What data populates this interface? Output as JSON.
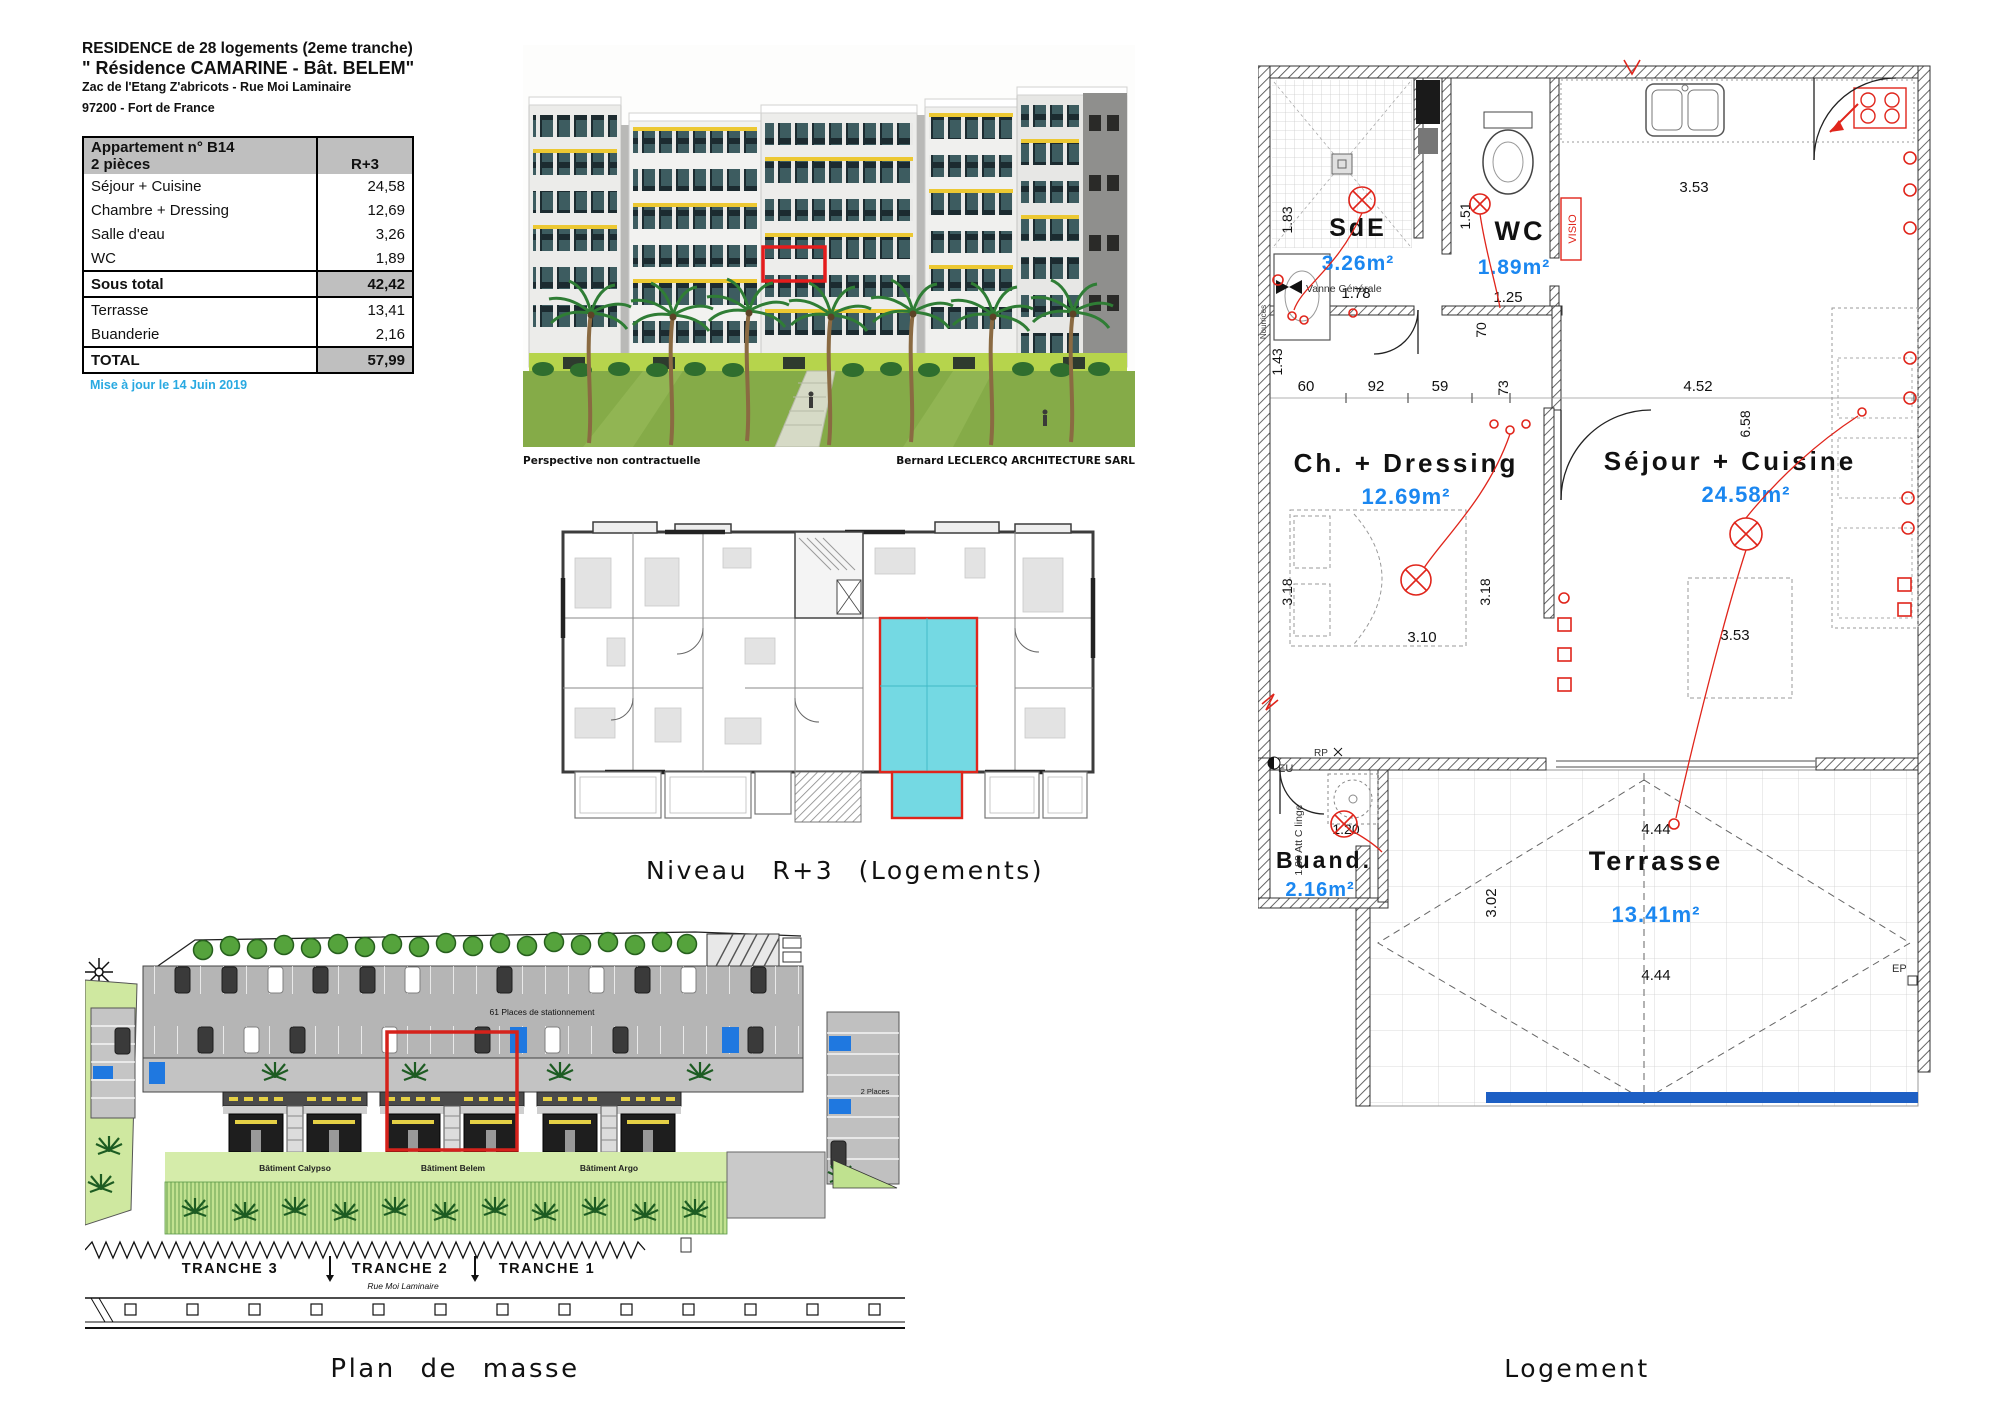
{
  "doc": {
    "title_line1": "RESIDENCE de 28 logements (2eme tranche)",
    "title_line2": "\" Résidence CAMARINE - Bât. BELEM\"",
    "title_line3": "Zac de l'Etang Z'abricots - Rue Moi Laminaire",
    "title_line4": "97200  - Fort de France",
    "update_note": "Mise à jour le 14 Juin 2019"
  },
  "area_table": {
    "header_title": "Appartement n° B14",
    "header_sub": "2 pièces",
    "header_col": "R+3",
    "rows": [
      {
        "label": "Séjour + Cuisine",
        "value": "24,58"
      },
      {
        "label": "Chambre + Dressing",
        "value": "12,69"
      },
      {
        "label": "Salle d'eau",
        "value": "3,26"
      },
      {
        "label": "WC",
        "value": "1,89"
      },
      {
        "label": "Sous total",
        "value": "42,42"
      },
      {
        "label": "Terrasse",
        "value": "13,41"
      },
      {
        "label": "Buanderie",
        "value": "2,16"
      },
      {
        "label": "TOTAL",
        "value": "57,99"
      }
    ]
  },
  "perspective": {
    "caption_left": "Perspective non contractuelle",
    "caption_right": "Bernard LECLERCQ ARCHITECTURE SARL"
  },
  "floor_plan": {
    "caption": "Niveau R+3 (Logements)"
  },
  "site_plan": {
    "caption": "Plan de masse",
    "parking_label": "61 Places de stationnement",
    "places_right_label": "2 Places",
    "building_left": "Bâtiment Calypso",
    "building_middle": "Bâtiment Belem",
    "building_right": "Bâtiment Argo",
    "tranche_3": "TRANCHE 3",
    "tranche_2": "TRANCHE 2",
    "tranche_1": "TRANCHE 1",
    "street": "Rue Moi Laminaire"
  },
  "apartment": {
    "caption": "Logement",
    "rooms": {
      "sde": {
        "name": "SdE",
        "area": "3.26m²"
      },
      "wc": {
        "name": "WC",
        "area": "1.89m²"
      },
      "ch": {
        "name": "Ch. + Dressing",
        "area": "12.69m²"
      },
      "sejour": {
        "name": "Séjour + Cuisine",
        "area": "24.58m²"
      },
      "buand": {
        "name": "Buand.",
        "area": "2.16m²"
      },
      "terrasse": {
        "name": "Terrasse",
        "area": "13.41m²"
      }
    },
    "dims": {
      "sde_width": "1.78",
      "sde_height": "1.83",
      "left_wall": "1.43",
      "wc_height": "1.51",
      "wc_width": "1.25",
      "kitchen_width": "3.53",
      "hall_a": "60",
      "hall_b": "92",
      "hall_c": "59",
      "hall_d": "73",
      "hall_e": "70",
      "sejour_top": "4.52",
      "sejour_right": "6.58",
      "ch_left": "3.18",
      "ch_right": "3.18",
      "ch_bottom": "3.10",
      "sejour_bottom": "3.53",
      "buand_width": "1.20",
      "buand_left": "1.80 Att C linge",
      "terrasse_height": "3.02",
      "terrasse_top": "4.44",
      "terrasse_bottom": "4.44"
    },
    "annotations": {
      "vanne": "Vanne Générale",
      "visio": "VISIO",
      "eu": "EU",
      "rp": "RP",
      "ep": "EP",
      "nourrices": "Nourrices"
    }
  },
  "colors": {
    "highlight_red": "#e0251b",
    "area_blue": "#1b87f0",
    "plan_cyan": "#74d9e3",
    "note_blue": "#29a9e1",
    "awning_yellow": "#ecc832",
    "handicap_blue": "#1f78e0"
  }
}
